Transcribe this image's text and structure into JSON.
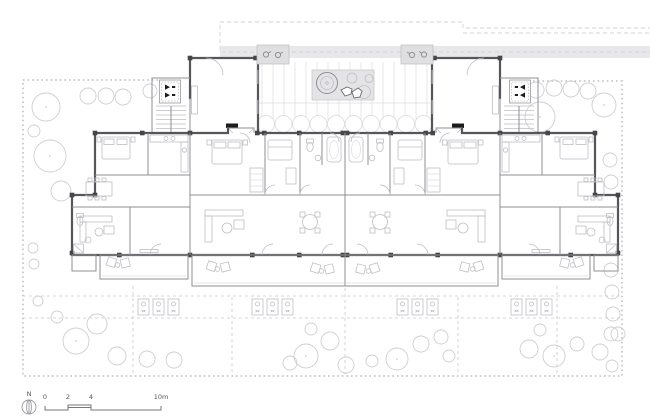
{
  "plan": {
    "kind": "architectural site / floor plan",
    "scale_bar": {
      "north_label": "N",
      "labels": [
        "0",
        "2",
        "4",
        "10m"
      ]
    },
    "palette": {
      "background": "#ffffff",
      "exterior_wall": "#55555a",
      "column_pier": "#46464a",
      "partition": "#8f8f94",
      "furniture": "#bfbfc4",
      "tree_outline": "#cfcfd4",
      "site_boundary_dash": "#c6c6cb",
      "pavement_band": "#e8e8ea",
      "symbol_black": "#1c1c1e"
    }
  }
}
